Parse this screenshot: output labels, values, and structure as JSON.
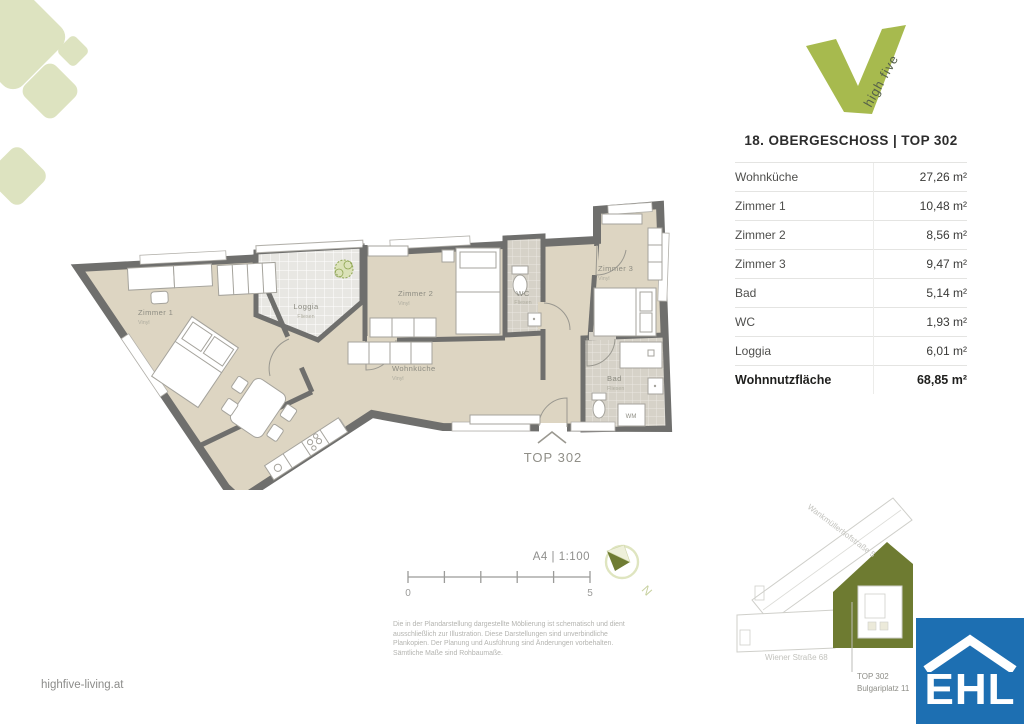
{
  "branding": {
    "logo_tagline": "high five",
    "website": "highfive-living.at"
  },
  "unit_table": {
    "title": "18. OBERGESCHOSS | TOP 302",
    "rows": [
      {
        "label": "Wohnküche",
        "area": "27,26 m²"
      },
      {
        "label": "Zimmer 1",
        "area": "10,48 m²"
      },
      {
        "label": "Zimmer 2",
        "area": "8,56 m²"
      },
      {
        "label": "Zimmer 3",
        "area": "9,47 m²"
      },
      {
        "label": "Bad",
        "area": "5,14 m²"
      },
      {
        "label": "WC",
        "area": "1,93 m²"
      },
      {
        "label": "Loggia",
        "area": "6,01 m²"
      },
      {
        "label": "Wohnnutzfläche",
        "area": "68,85 m²"
      }
    ]
  },
  "plan": {
    "unit_label": "TOP 302",
    "wm_label": "WM",
    "rooms": [
      {
        "name": "Zimmer 1",
        "floor": "Vinyl"
      },
      {
        "name": "Loggia",
        "floor": "Fliesen"
      },
      {
        "name": "Zimmer 2",
        "floor": "Vinyl"
      },
      {
        "name": "Wohnküche",
        "floor": "Vinyl"
      },
      {
        "name": "WC",
        "floor": "Fliesen"
      },
      {
        "name": "Zimmer 3",
        "floor": "Vinyl"
      },
      {
        "name": "Bad",
        "floor": "Fliesen"
      }
    ]
  },
  "scale": {
    "label": "A4 | 1:100",
    "start": "0",
    "end": "5"
  },
  "compass": {
    "label": "N"
  },
  "disclaimer": {
    "lines": [
      "Die in der Plandarstellung dargestellte Möblierung ist schematisch und dient",
      "ausschließlich zur Illustration. Diese Darstellungen sind unverbindliche",
      "Plankopien. Der Planung und Ausführung sind Änderungen vorbehalten.",
      "Sämtliche Maße sind Rohbaumaße."
    ]
  },
  "site_plan": {
    "street_diagonal": "Wankmüllerhofstraße 5",
    "street_bottom": "Wiener Straße 68",
    "unit_line1": "TOP 302",
    "unit_line2": "Bulgariplatz 11"
  },
  "ehl": {
    "text": "EHL"
  },
  "colors": {
    "accent_green": "#a7ba4e",
    "pale_green": "#dde3c0",
    "olive": "#6e7b31",
    "ehl_blue": "#1d6fb2",
    "room_beige": "#ddd5c2",
    "wall_gray": "#6f6f6d"
  }
}
